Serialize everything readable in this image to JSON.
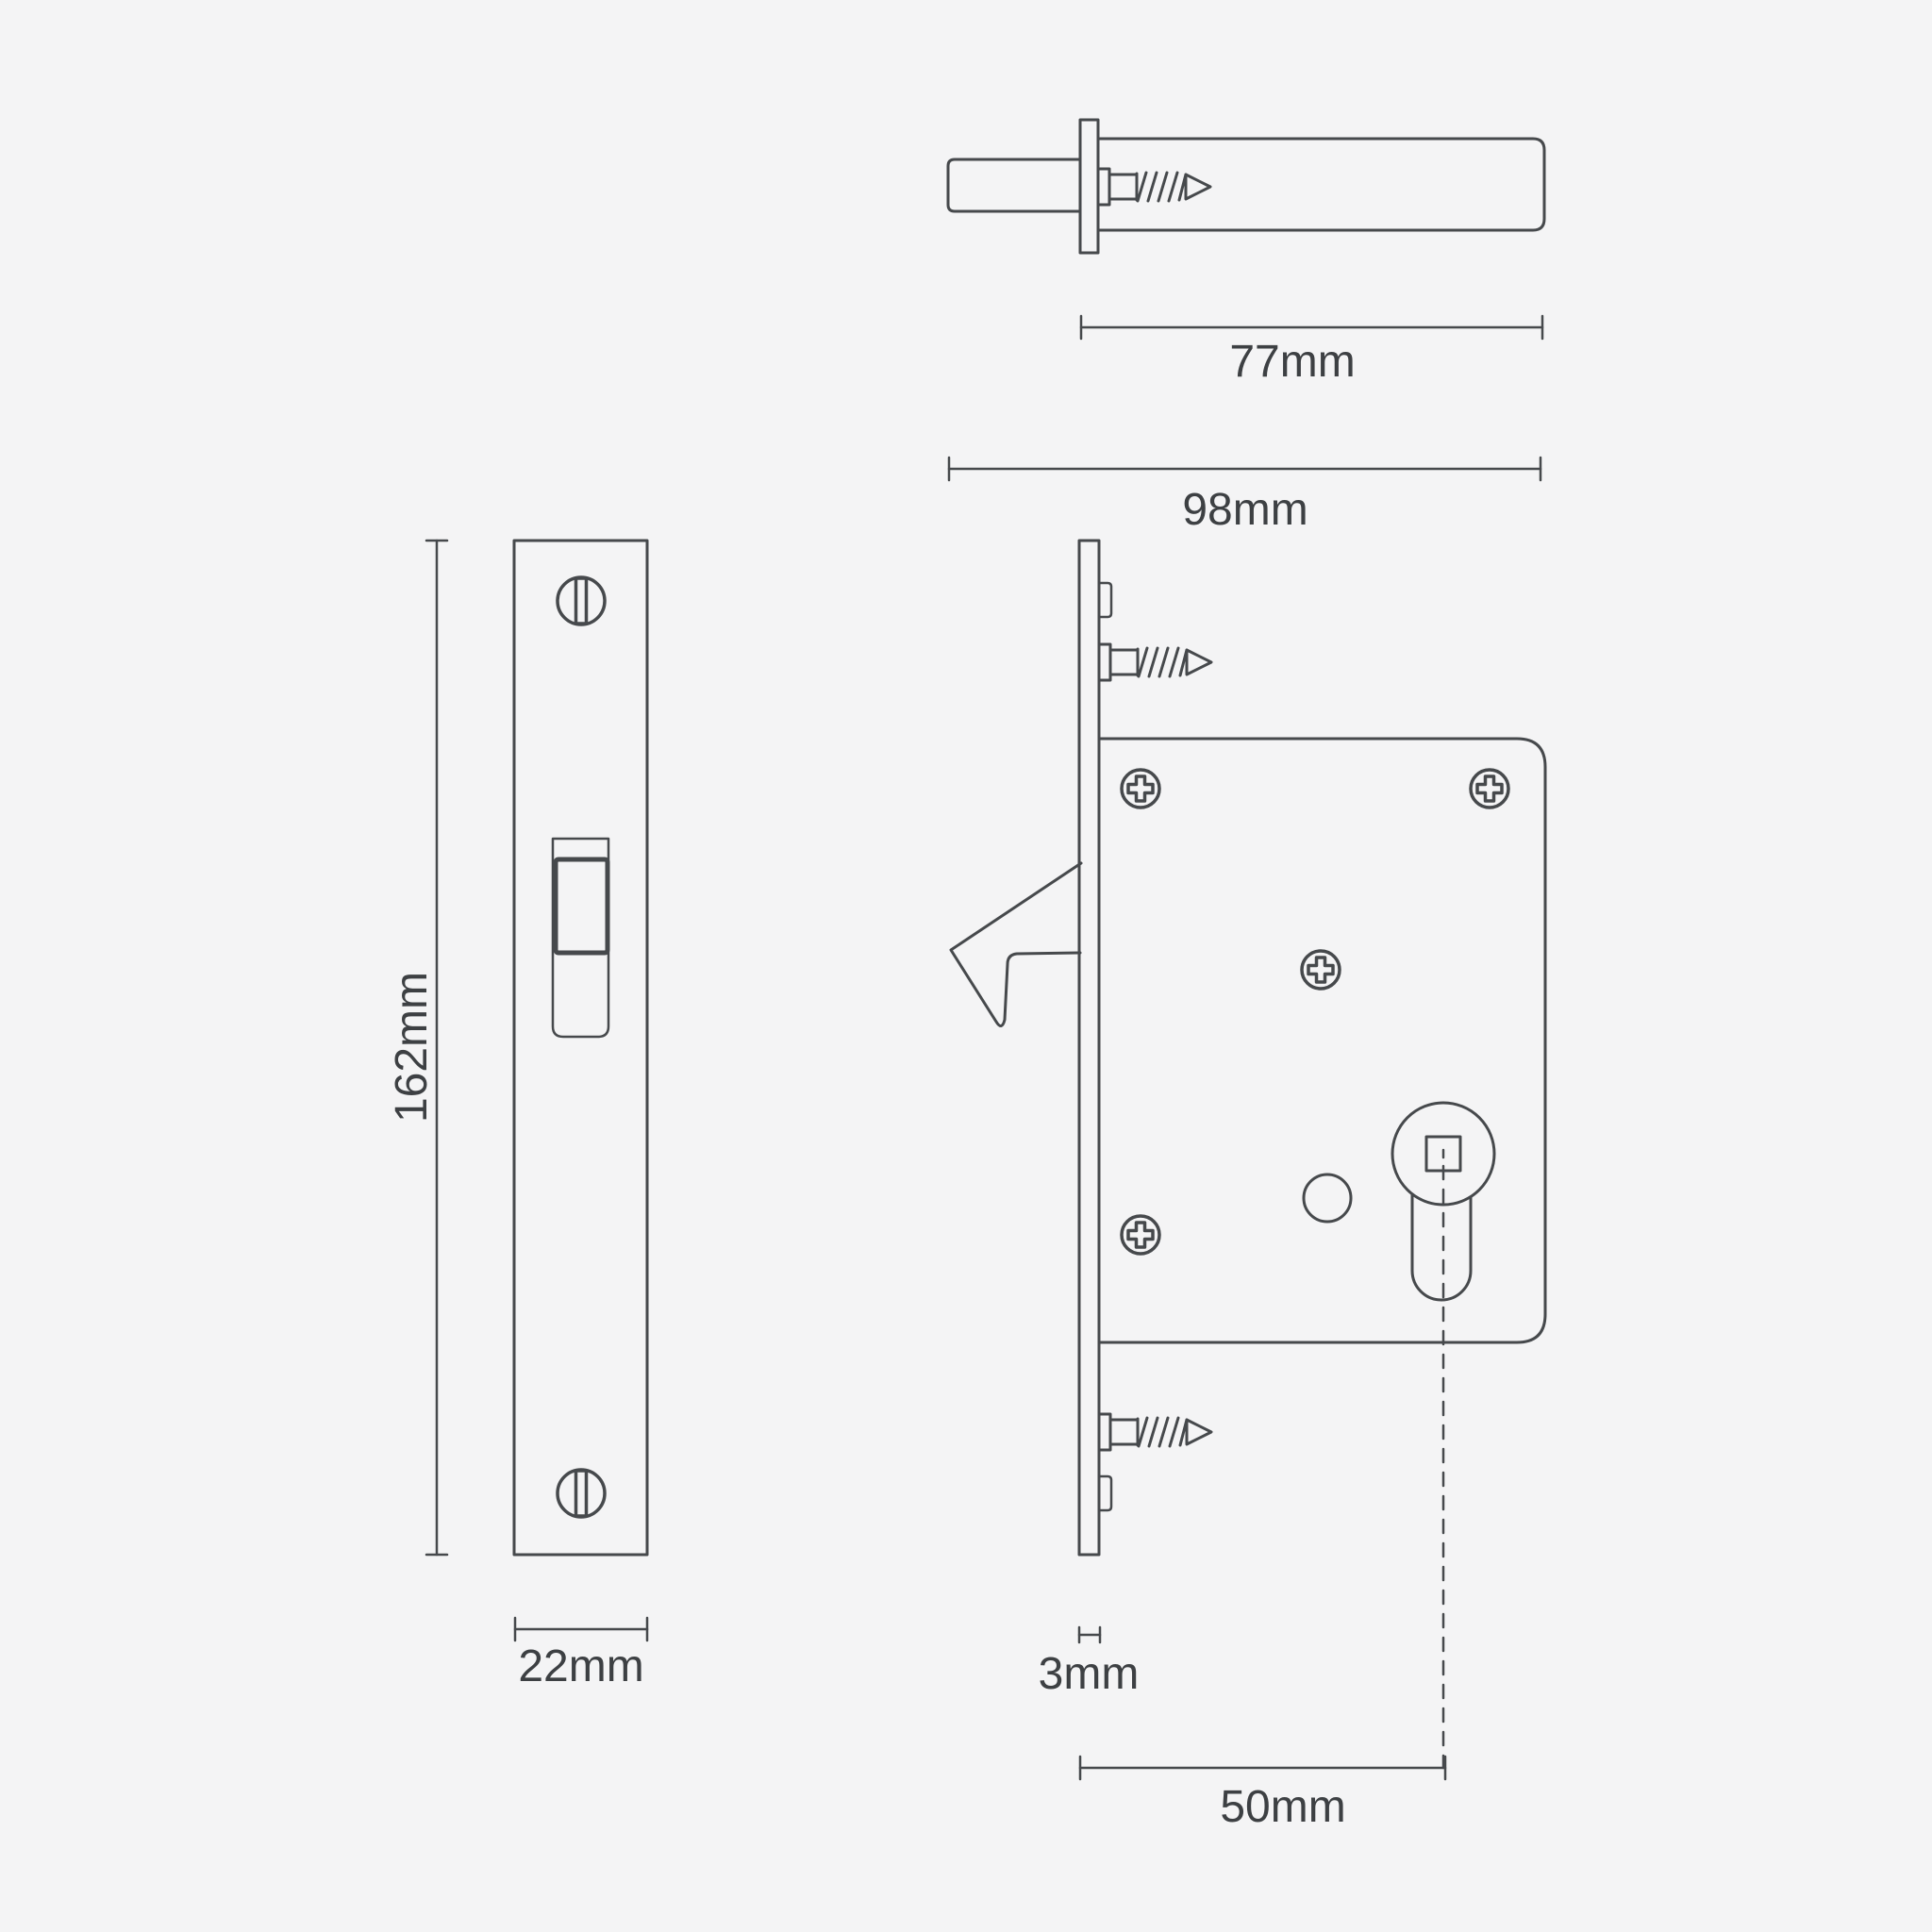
{
  "page": {
    "background": "#f4f4f5",
    "line_color": "#46494c",
    "text_color": "#3d4043",
    "description": "Technical dimension drawing of a sliding-door hook mortice lock with cylinder fixing"
  },
  "dimensions": {
    "cylinder_length": "77mm",
    "overall_length": "98mm",
    "faceplate_height": "162mm",
    "faceplate_width": "22mm",
    "faceplate_thickness": "3mm",
    "backset": "50mm"
  }
}
